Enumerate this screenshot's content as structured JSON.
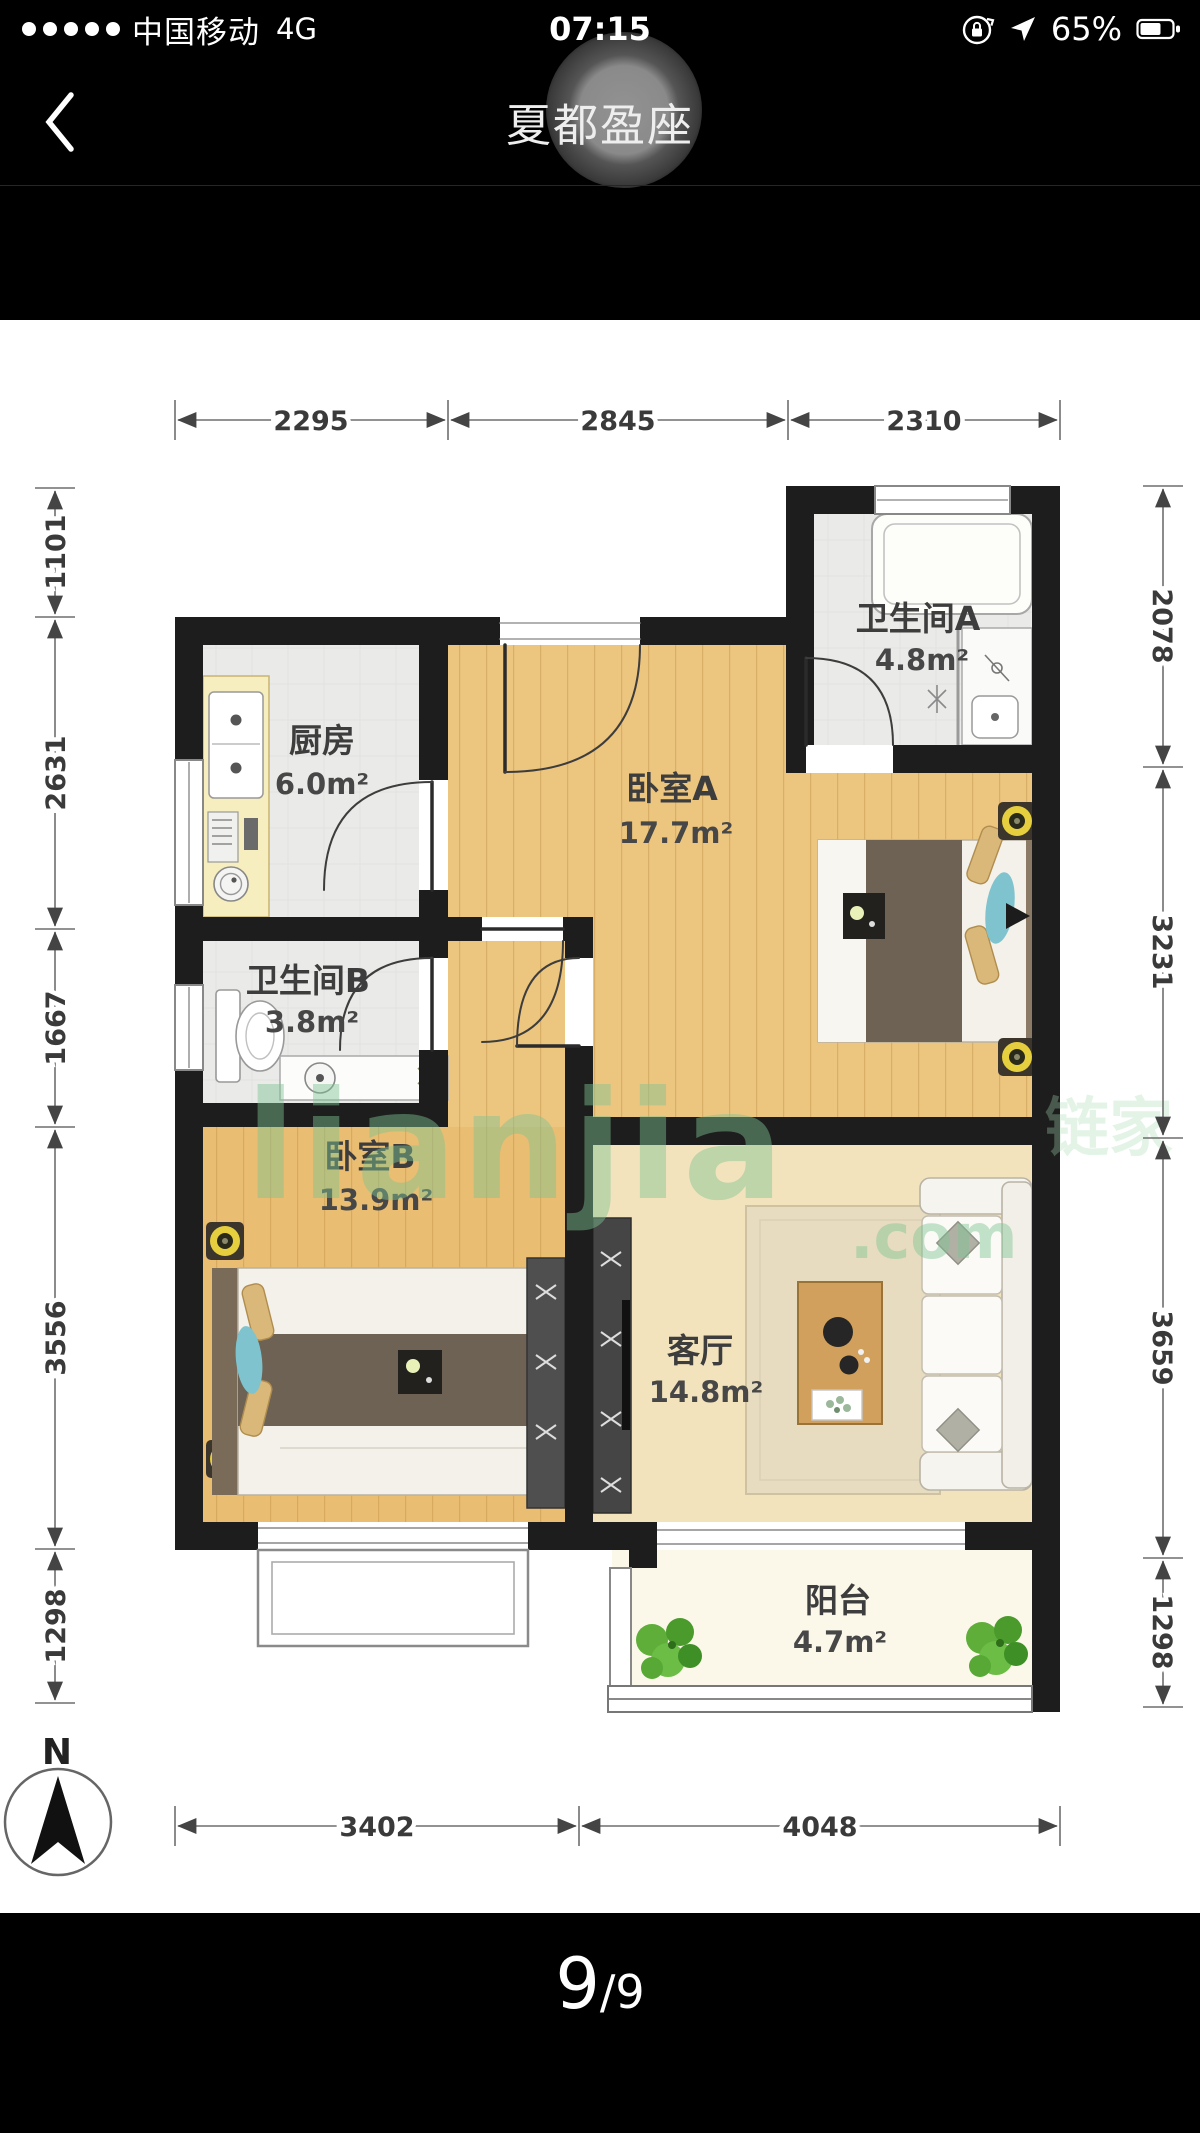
{
  "status_bar": {
    "carrier": "中国移动",
    "network": "4G",
    "time": "07:15",
    "battery": "65%",
    "signal_dots": 5
  },
  "nav": {
    "title": "夏都盈座"
  },
  "floorplan": {
    "rooms": [
      {
        "id": "kitchen",
        "name": "厨房",
        "area": "6.0m²"
      },
      {
        "id": "bathroom-a",
        "name": "卫生间A",
        "area": "4.8m²"
      },
      {
        "id": "bedroom-a",
        "name": "卧室A",
        "area": "17.7m²"
      },
      {
        "id": "bathroom-b",
        "name": "卫生间B",
        "area": "3.8m²"
      },
      {
        "id": "bedroom-b",
        "name": "卧室B",
        "area": "13.9m²"
      },
      {
        "id": "living",
        "name": "客厅",
        "area": "14.8m²"
      },
      {
        "id": "balcony",
        "name": "阳台",
        "area": "4.7m²"
      }
    ],
    "dims": {
      "top": [
        "2295",
        "2845",
        "2310"
      ],
      "bottom": [
        "3402",
        "4048"
      ],
      "left": [
        "1101",
        "2631",
        "1667",
        "3556",
        "1298"
      ],
      "right": [
        "2078",
        "3231",
        "3659",
        "1298"
      ]
    },
    "compass": "N",
    "watermark": {
      "brand": "lianjia",
      "tld": ".com",
      "cn": "链家"
    },
    "colors": {
      "wall": "#1d1d1d",
      "wood": "#ecc57f",
      "tile": "#f3e3bd",
      "gray_floor": "#eaeae8",
      "watermark_green": "#7fc493",
      "accent_teal": "#7fc3cf"
    }
  },
  "pager": {
    "current": "9",
    "rest": "/9"
  }
}
